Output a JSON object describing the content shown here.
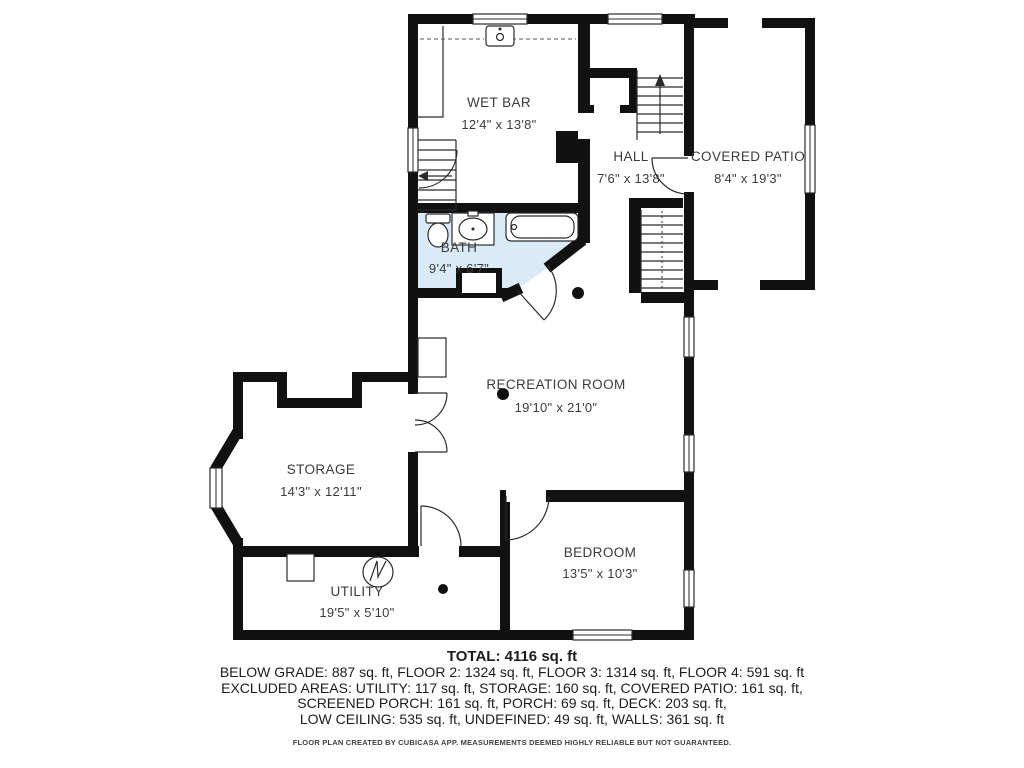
{
  "colors": {
    "wall": "#111111",
    "bath_fill": "#d8ebf7",
    "label_text": "#3b3b3b"
  },
  "rooms": [
    {
      "name": "WET BAR",
      "dims": "12'4\" x 13'8\""
    },
    {
      "name": "HALL",
      "dims": "7'6\" x 13'8\""
    },
    {
      "name": "COVERED PATIO",
      "dims": "8'4\" x 19'3\""
    },
    {
      "name": "BATH",
      "dims": "9'4\" x 6'7\""
    },
    {
      "name": "RECREATION ROOM",
      "dims": "19'10\" x 21'0\""
    },
    {
      "name": "STORAGE",
      "dims": "14'3\" x 12'11\""
    },
    {
      "name": "UTILITY",
      "dims": "19'5\" x 5'10\""
    },
    {
      "name": "BEDROOM",
      "dims": "13'5\" x 10'3\""
    }
  ],
  "footer": {
    "total": "TOTAL: 4116 sq. ft",
    "line1": "BELOW GRADE: 887 sq. ft, FLOOR 2: 1324 sq. ft, FLOOR 3: 1314 sq. ft, FLOOR 4: 591 sq. ft",
    "line2": "EXCLUDED AREAS: UTILITY: 117 sq. ft, STORAGE: 160 sq. ft, COVERED PATIO: 161 sq. ft,",
    "line3": "SCREENED PORCH: 161 sq. ft, PORCH: 69 sq. ft, DECK: 203 sq. ft,",
    "line4": "LOW CEILING: 535 sq. ft, UNDEFINED: 49 sq. ft, WALLS: 361 sq. ft",
    "disclaimer": "FLOOR PLAN CREATED BY CUBICASA APP. MEASUREMENTS DEEMED HIGHLY RELIABLE BUT NOT GUARANTEED."
  }
}
